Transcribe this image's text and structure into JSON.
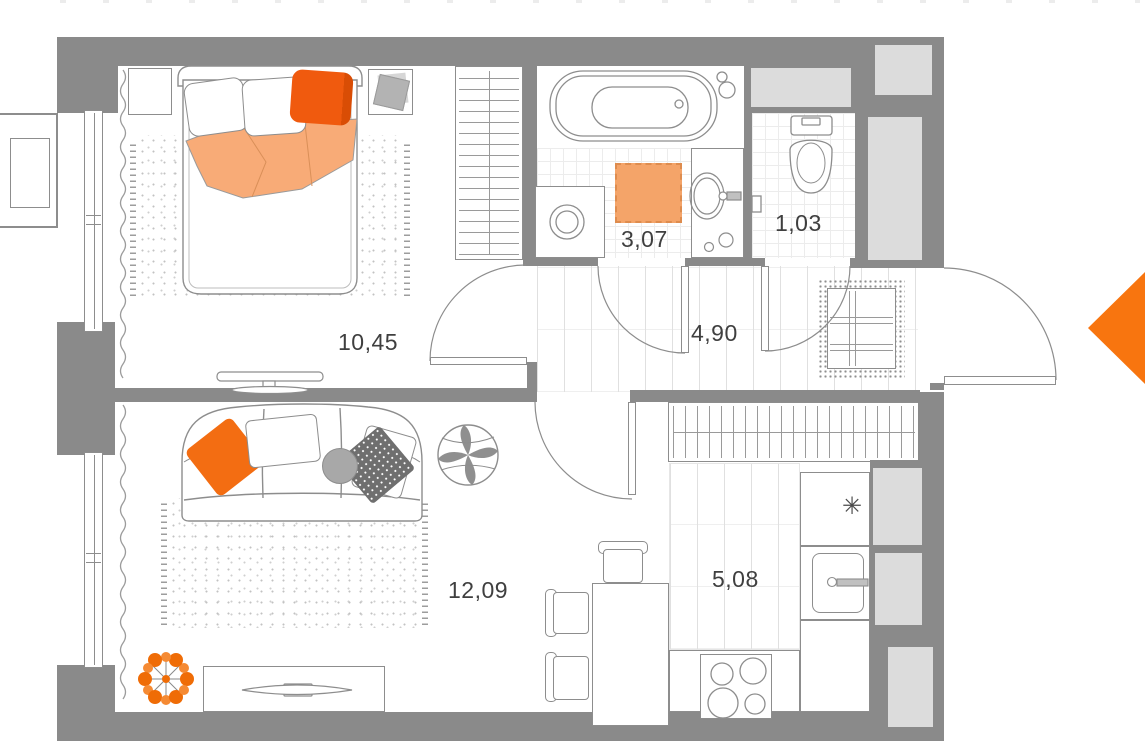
{
  "plan": {
    "name": "one-room apartment floor plan",
    "rooms": [
      {
        "key": "bedroom",
        "area": "10,45"
      },
      {
        "key": "bathroom",
        "area": "3,07"
      },
      {
        "key": "toilet",
        "area": "1,03"
      },
      {
        "key": "hallway",
        "area": "4,90"
      },
      {
        "key": "living_room",
        "area": "12,09"
      },
      {
        "key": "kitchen",
        "area": "5,08"
      }
    ],
    "icons": {
      "fridge_snowflake": "✳"
    },
    "entrance_marker": {
      "shape": "triangle-pointing-left",
      "color": "#f8750f"
    },
    "colors": {
      "wall": "#8a8a8a",
      "shaft": "#dcdcdc",
      "line": "#8d8d8d",
      "orange_arrow": "#f8750f",
      "orange_pillow": "#f05a0e",
      "orange_blanket": "#f8ab77",
      "orange_mat": "#f4a469",
      "orange_plant": "#ef6c06"
    }
  }
}
